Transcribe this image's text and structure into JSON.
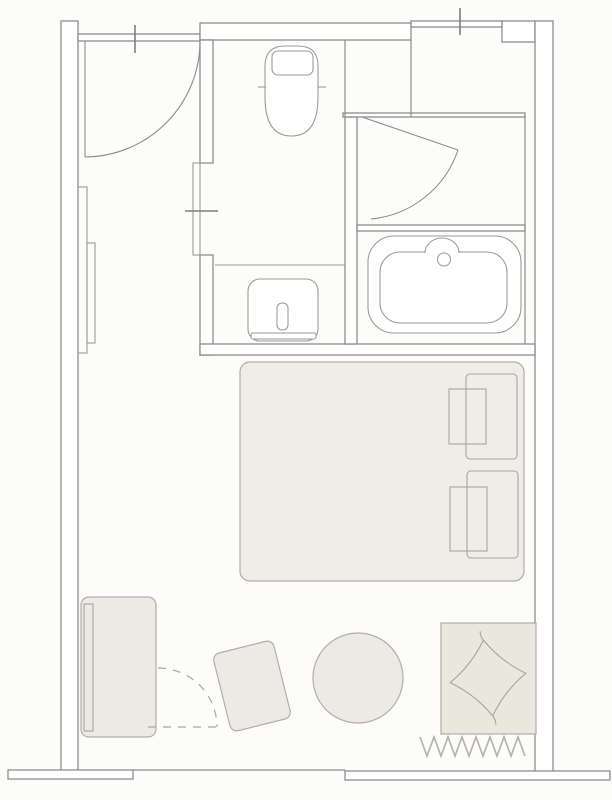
{
  "meta": {
    "title": "Hotel guest room floor plan",
    "type": "architectural-floor-plan",
    "canvas": {
      "width_px": 612,
      "height_px": 800
    },
    "text_labels": []
  },
  "palette": {
    "background": "#fcfcfb",
    "wall_fill": "#ffffff",
    "wall_line": "#8d8d8d",
    "fixture_line": "#9a9a98",
    "furniture_line": "#b2aea7",
    "furniture_fill": "#edeae3",
    "bed_fill": "#f0ede8",
    "rug_fill": "#eae7df",
    "cushion_fill": "#f1eee8",
    "fringe_line": "#b5b1a8"
  },
  "rooms": [
    {
      "name": "entry-hall"
    },
    {
      "name": "toilet-compartment"
    },
    {
      "name": "vanity-area"
    },
    {
      "name": "shower-room"
    },
    {
      "name": "bathtub-area"
    },
    {
      "name": "bedroom"
    }
  ],
  "fixtures": [
    {
      "name": "toilet"
    },
    {
      "name": "wash-basin-with-faucet"
    },
    {
      "name": "bathtub-with-drain"
    },
    {
      "name": "entry-door-swing"
    },
    {
      "name": "shower-door-swing"
    },
    {
      "name": "pocket-sliding-door"
    },
    {
      "name": "dashed-swing-path"
    }
  ],
  "furniture": [
    {
      "name": "double-bed"
    },
    {
      "name": "bed-pillow",
      "count": 2
    },
    {
      "name": "console-desk"
    },
    {
      "name": "wardrobe-panels",
      "count": 2
    },
    {
      "name": "lounge-chair"
    },
    {
      "name": "round-table"
    },
    {
      "name": "rug-with-fringe"
    },
    {
      "name": "floor-cushion"
    }
  ],
  "dimension_ticks": [
    {
      "name": "tick-top-left-wall"
    },
    {
      "name": "tick-top-right-window"
    },
    {
      "name": "tick-pocket-door"
    }
  ]
}
